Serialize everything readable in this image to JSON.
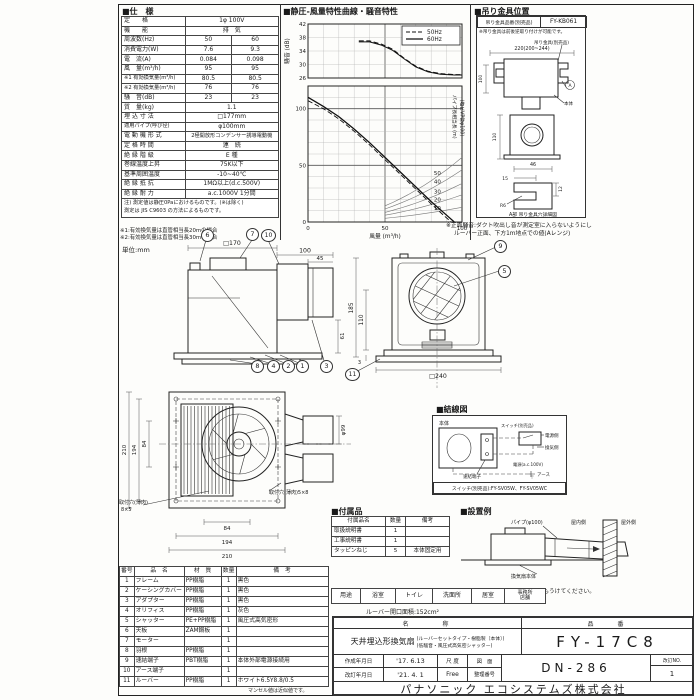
{
  "chart_data": [
    {
      "type": "line",
      "title": "騒音特性",
      "xlabel": "風量 (m³/h)",
      "ylabel": "騒音 (dB)",
      "xlim": [
        0,
        100
      ],
      "ylim": [
        26,
        42
      ],
      "xticks": [
        0,
        50,
        100
      ],
      "yticks": [
        26,
        30,
        34,
        38,
        42
      ],
      "grid": true,
      "legend_position": "top-right",
      "series": [
        {
          "name": "50Hz",
          "style": "dashed",
          "points": [
            [
              33,
              37
            ],
            [
              40,
              37
            ],
            [
              48,
              36
            ],
            [
              55,
              34.5
            ],
            [
              62,
              32
            ],
            [
              70,
              29.5
            ],
            [
              78,
              28
            ],
            [
              86,
              27.3
            ],
            [
              95,
              27
            ],
            [
              100,
              27
            ]
          ]
        },
        {
          "name": "60Hz",
          "style": "solid",
          "points": [
            [
              33,
              36.7
            ],
            [
              40,
              36.7
            ],
            [
              48,
              35.7
            ],
            [
              55,
              34.2
            ],
            [
              62,
              31.8
            ],
            [
              70,
              29.3
            ],
            [
              78,
              27.8
            ],
            [
              86,
              27.1
            ],
            [
              95,
              26.9
            ],
            [
              100,
              26.9
            ]
          ]
        }
      ]
    },
    {
      "type": "line",
      "title": "静圧-風量特性曲線",
      "xlabel": "風量 (m³/h)",
      "ylabel": "静圧 (Pa)",
      "xlim": [
        0,
        100
      ],
      "ylim": [
        0,
        120
      ],
      "xticks": [
        0,
        50,
        100
      ],
      "yticks": [
        0,
        50,
        100
      ],
      "grid": true,
      "series": [
        {
          "name": "50Hz",
          "style": "dashed",
          "points": [
            [
              0,
              107
            ],
            [
              10,
              100
            ],
            [
              20,
              91
            ],
            [
              30,
              80
            ],
            [
              40,
              68
            ],
            [
              50,
              55
            ],
            [
              60,
              42
            ],
            [
              70,
              29
            ],
            [
              80,
              16
            ],
            [
              88,
              6
            ],
            [
              93,
              0
            ]
          ]
        },
        {
          "name": "60Hz",
          "style": "solid",
          "points": [
            [
              0,
              110
            ],
            [
              10,
              102
            ],
            [
              20,
              93
            ],
            [
              30,
              82
            ],
            [
              40,
              70
            ],
            [
              50,
              57
            ],
            [
              60,
              44
            ],
            [
              70,
              31
            ],
            [
              80,
              18
            ],
            [
              90,
              6
            ],
            [
              95,
              0
            ]
          ]
        }
      ],
      "pipe_curves": {
        "label": "パイプ長相当長 (m)",
        "sublabel": "(塩ビVP管φ100)",
        "lengths": [
          10,
          20,
          30,
          40,
          50
        ],
        "p_at_q100": [
          13,
          24,
          34,
          46,
          57
        ]
      }
    }
  ],
  "spec": {
    "title": "■仕　様",
    "rows": [
      {
        "label": "定　　格",
        "value": "1φ 100V"
      },
      {
        "label": "機　　能",
        "value": "排　気"
      },
      {
        "label": "周波数(Hz)",
        "v50": "50",
        "v60": "60"
      },
      {
        "label": "消費電力(W)",
        "v50": "7.6",
        "v60": "9.3"
      },
      {
        "label": "電　流(A)",
        "v50": "0.084",
        "v60": "0.098"
      },
      {
        "label": "風　量(m³/h)",
        "v50": "95",
        "v60": "95"
      },
      {
        "label": "※1 有効換気量(m³/h)",
        "v50": "80.5",
        "v60": "80.5"
      },
      {
        "label": "※2 有効換気量(m³/h)",
        "v50": "76",
        "v60": "76"
      },
      {
        "label": "騒　音(dB)",
        "v50": "23",
        "v60": "23"
      },
      {
        "label": "質　量(kg)",
        "value": "1.1"
      },
      {
        "label": "埋 込 寸 法",
        "value": "□177mm"
      },
      {
        "label": "適用パイプ(呼び径)",
        "value": "φ100mm"
      },
      {
        "label": "電 動 機 形 式",
        "value": "2極開放形コンデンサー誘導電動機"
      },
      {
        "label": "定 格 時 間",
        "value": "連　続"
      },
      {
        "label": "絶 縁 階 級",
        "value": "E 種"
      },
      {
        "label": "巻線温度上昇",
        "value": "75K以下"
      },
      {
        "label": "基準周囲温度",
        "value": "-10~40℃"
      },
      {
        "label": "絶 縁 抵 抗",
        "value": "1MΩ以上(d.c.500V)"
      },
      {
        "label": "絶 縁 耐 力",
        "value": "a.c.1000V 1分間"
      }
    ],
    "note1": "注) 測定値は静圧0Paにおけるものです。(※は除く)",
    "note2": "測定は JIS C9603 の方法によるものです。",
    "footnote1": "※1:有効換気量は直管相当長20mの場合",
    "footnote2": "※2:有効換気量は直管相当長30mの場合",
    "unit": "単位:mm"
  },
  "chart_section": {
    "title": "■静圧-風量特性曲線・騒音特性",
    "front_noise_note1": "※正面騒音:ダクト吹出し音が測定室に入らないようにし",
    "front_noise_note2": "ルーバー正面、下方1m地点での値(Aレンジ)"
  },
  "bracket": {
    "title": "■吊り金具位置",
    "part_label": "吊り金具品番(別売品)",
    "part_no": "FY-KB061",
    "note": "※吊り金具は前後逆取り付けが可能です。",
    "lbl_bracket": "吊り金具(別売品)",
    "lbl_body": "本体",
    "mark_a": "A",
    "detail_caption": "A部 吊り金具穴詳細図",
    "dims": [
      "220(200~244)",
      "100",
      "110",
      "46",
      "15",
      "12",
      "R6"
    ]
  },
  "views": {
    "side": {
      "dims": [
        "□170",
        "100",
        "45",
        "61"
      ]
    },
    "front": {
      "dims": [
        "185",
        "110",
        "3",
        "□240"
      ]
    },
    "plan": {
      "dims": [
        "210",
        "194",
        "84",
        "84",
        "194",
        "210",
        "φ99"
      ],
      "hole_l1": "取付穴(薄肉)",
      "hole_l2": "8×5",
      "hole_r": "取付穴(薄肉)5×8"
    }
  },
  "callouts": {
    "n1": "1",
    "n2": "2",
    "n3": "3",
    "n4": "4",
    "n5": "5",
    "n6": "6",
    "n7": "7",
    "n8": "8",
    "n9": "9",
    "n10": "10",
    "n11": "11"
  },
  "wiring": {
    "title": "■結線図",
    "body": "本体",
    "terminal": "速結端子",
    "switch": "スイッチ(別売品)",
    "side1": "電源側",
    "side2": "換気側",
    "power": "電源(a.c.100V)",
    "earth": "アース",
    "models": "スイッチ(別売品):FY-SV05W、FY-SV05WC"
  },
  "accessories": {
    "title": "■付属品",
    "headers": [
      "付属品名",
      "数量",
      "備考"
    ],
    "rows": [
      {
        "name": "取扱説明書",
        "qty": "1",
        "remark": ""
      },
      {
        "name": "工事説明書",
        "qty": "1",
        "remark": ""
      },
      {
        "name": "タッピンねじ",
        "qty": "5",
        "remark": "本体固定用"
      }
    ]
  },
  "install": {
    "title": "■設置例",
    "pipe": "パイプ(φ100)",
    "indoor": "屋内側",
    "outdoor": "屋外側",
    "body": "換気扇本体",
    "note": "注) ダクトは必ず屋外側に勾配をもうけてください。"
  },
  "usage": {
    "label": "用途",
    "items": [
      "浴室",
      "トイレ",
      "洗面所",
      "居室",
      "事務所",
      "店舗"
    ],
    "louver_area": "ルーバー開口面積:152cm²"
  },
  "parts": {
    "headers": [
      "番号",
      "品　名",
      "材　質",
      "数量",
      "備　考"
    ],
    "rows": [
      {
        "no": "1",
        "name": "フレーム",
        "material": "PP樹脂",
        "qty": "1",
        "remark": "黒色"
      },
      {
        "no": "2",
        "name": "ケーシングカバー",
        "material": "PP樹脂",
        "qty": "1",
        "remark": "黒色"
      },
      {
        "no": "3",
        "name": "アダプター",
        "material": "PP樹脂",
        "qty": "1",
        "remark": "黒色"
      },
      {
        "no": "4",
        "name": "オリフィス",
        "material": "PP樹脂",
        "qty": "1",
        "remark": "灰色"
      },
      {
        "no": "5",
        "name": "シャッター",
        "material": "PE+PP樹脂",
        "qty": "1",
        "remark": "風圧式高気密形"
      },
      {
        "no": "6",
        "name": "天板",
        "material": "ZAM鋼板",
        "qty": "1",
        "remark": ""
      },
      {
        "no": "7",
        "name": "モーター",
        "material": "",
        "qty": "1",
        "remark": ""
      },
      {
        "no": "8",
        "name": "羽根",
        "material": "PP樹脂",
        "qty": "1",
        "remark": ""
      },
      {
        "no": "9",
        "name": "速結端子",
        "material": "PBT樹脂",
        "qty": "1",
        "remark": "本体外部電源接続用"
      },
      {
        "no": "10",
        "name": "アース端子",
        "material": "",
        "qty": "1",
        "remark": ""
      },
      {
        "no": "11",
        "name": "ルーバー",
        "material": "PP樹脂",
        "qty": "1",
        "remark": "ホワイト6.5Y8.8/0.5"
      }
    ],
    "note": "マンセル値は近似値です。"
  },
  "titleblock": {
    "name_label": "名　　　称",
    "model_label": "品　　番",
    "product": "天井埋込形換気扇",
    "sub1": "(ルーバーセットタイプ・樹脂製〔本体〕)",
    "sub2": "(低騒音・風圧式高気密シャッター)",
    "model": "FY-17C8",
    "created_label": "作成年月日",
    "created": "'17. 6.13",
    "revised_label": "改訂年月日",
    "revised": "'21. 4. 1",
    "scale_label": "尺 度",
    "scale": "Free",
    "dwg_label1": "図　面",
    "dwg_label2": "整理番号",
    "dwg_no": "DN-286",
    "rev_label": "改訂NO.",
    "rev": "1",
    "company": "パナソニック エコシステムズ株式会社"
  }
}
